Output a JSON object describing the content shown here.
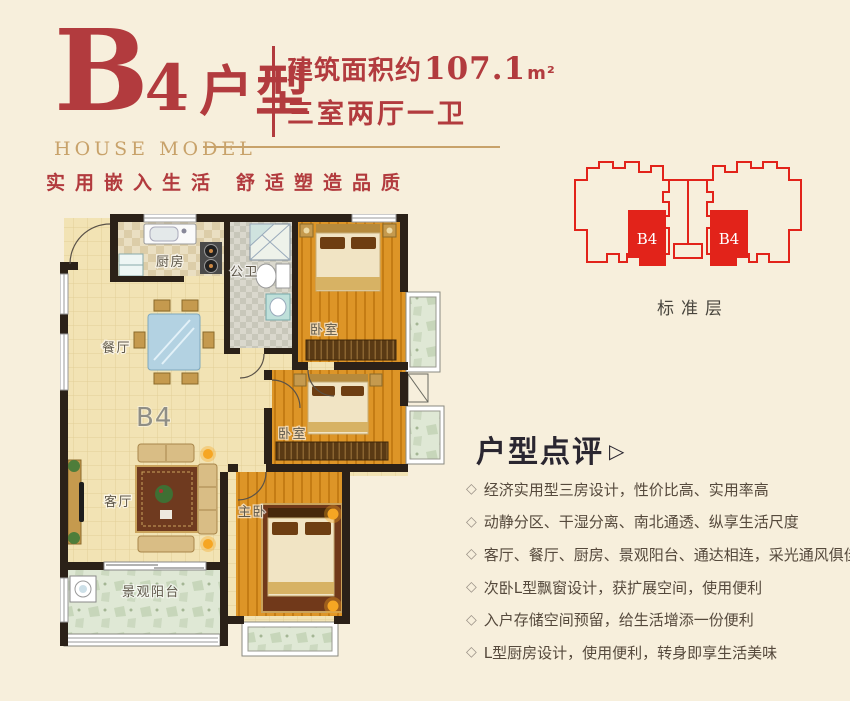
{
  "header": {
    "title": {
      "letter": "B",
      "number": "4",
      "suffix": "户型"
    },
    "subtitle_en": "HOUSE MODEL",
    "spec": {
      "area_prefix": "建筑面积约",
      "area_value": "107.1",
      "area_unit": "m²",
      "layout": "三室两厅一卫"
    },
    "slogan": {
      "left": "实用嵌入生活",
      "right": "舒适塑造品质"
    }
  },
  "floorplan": {
    "unit_label": "B4",
    "labels": {
      "kitchen": "厨房",
      "bath": "公卫",
      "bedroom1": "卧室",
      "dining": "餐厅",
      "bedroom2": "卧室",
      "living": "客厅",
      "master": "主卧",
      "balcony": "景观阳台"
    }
  },
  "site": {
    "caption": "标准层",
    "block_labels": [
      "B4",
      "B4"
    ]
  },
  "review": {
    "heading": "户型点评",
    "arrow": "▷",
    "bullet": "◇",
    "items": [
      "经济实用型三房设计，性价比高、实用率高",
      "动静分区、干湿分离、南北通透、纵享生活尺度",
      "客厅、餐厅、厨房、景观阳台、通达相连，采光通风俱佳",
      "次卧L型飘窗设计，获扩展空间，使用便利",
      "入户存储空间预留，给生活增添一份便利",
      "L型厨房设计，使用便利，转身即享生活美味"
    ]
  },
  "colors": {
    "brand_red": "#b23b3e",
    "site_red": "#e2231a",
    "gold": "#c8a26a"
  }
}
